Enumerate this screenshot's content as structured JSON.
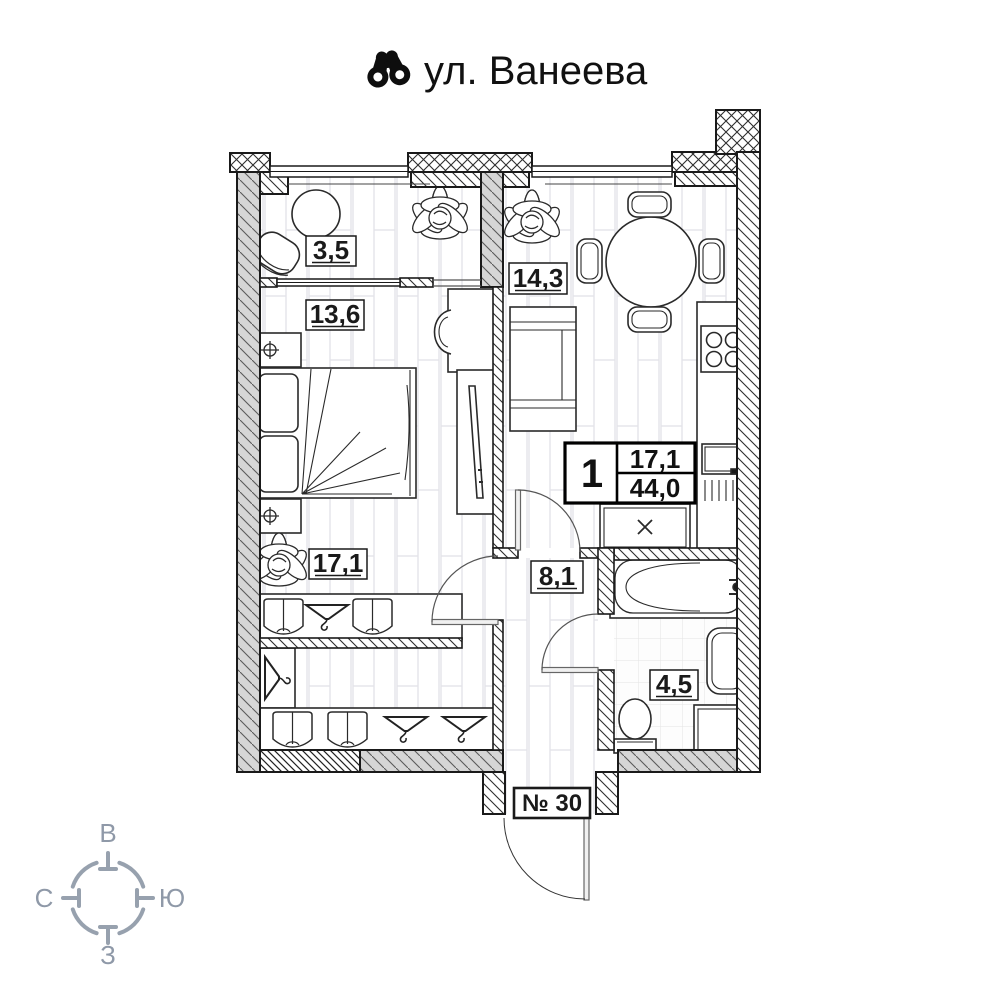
{
  "title": {
    "street": "ул. Ванеева",
    "icon": "binoculars-icon"
  },
  "plan": {
    "rooms": [
      {
        "name": "loggia",
        "area": "3,5"
      },
      {
        "name": "bedroom",
        "area": "13,6"
      },
      {
        "name": "kitchen-living",
        "area": "14,3"
      },
      {
        "name": "living",
        "area": "17,1"
      },
      {
        "name": "hallway",
        "area": "8,1"
      },
      {
        "name": "bathroom",
        "area": "4,5"
      }
    ],
    "info_box": {
      "rooms_count": "1",
      "living_area": "17,1",
      "total_area": "44,0"
    },
    "apartment_number": "№ 30"
  },
  "compass": {
    "east_label": "В",
    "north_label": "С",
    "south_label": "Ю",
    "west_label": "З"
  },
  "colors": {
    "ink": "#1a1a1a",
    "compass": "#8f99a8",
    "wall_gray": "#d9d9d9"
  }
}
